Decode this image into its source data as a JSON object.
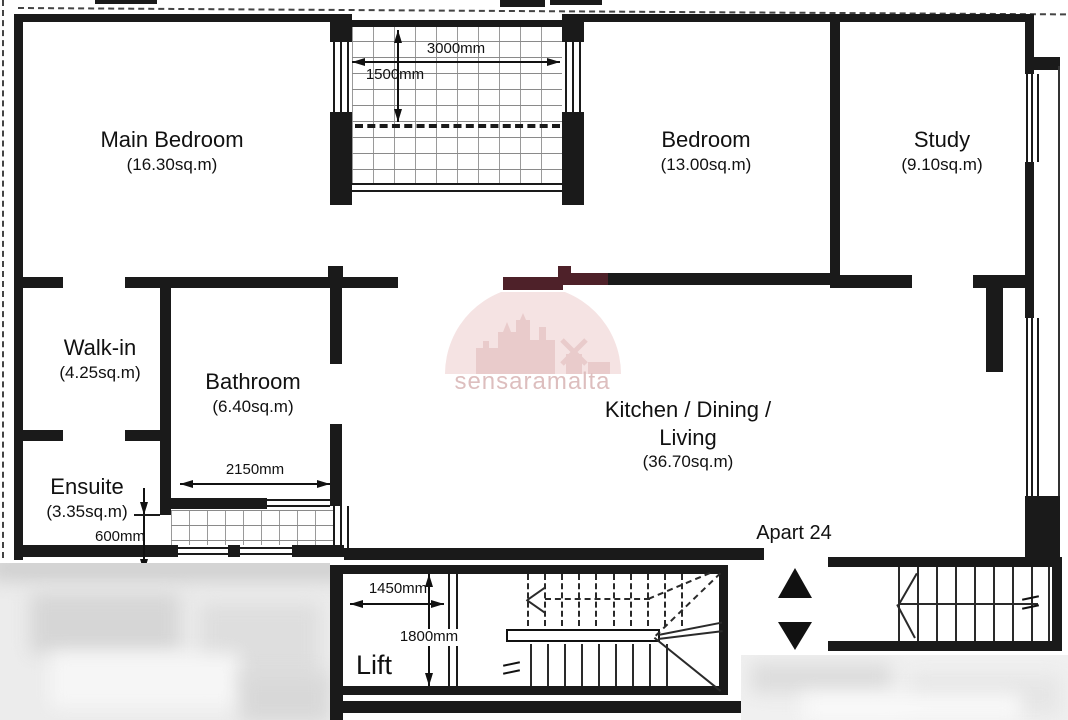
{
  "plan": {
    "apartment_label": "Apart 24",
    "watermark": {
      "brand": "sensaramalta"
    },
    "rooms": {
      "main_bedroom": {
        "name": "Main Bedroom",
        "area": "(16.30sq.m)"
      },
      "bedroom": {
        "name": "Bedroom",
        "area": "(13.00sq.m)"
      },
      "study": {
        "name": "Study",
        "area": "(9.10sq.m)"
      },
      "walk_in": {
        "name": "Walk-in",
        "area": "(4.25sq.m)"
      },
      "bathroom": {
        "name": "Bathroom",
        "area": "(6.40sq.m)"
      },
      "ensuite": {
        "name": "Ensuite",
        "area": "(3.35sq.m)"
      },
      "kitchen": {
        "name_line1": "Kitchen / Dining /",
        "name_line2": "Living",
        "area": "(36.70sq.m)"
      },
      "lift": {
        "name": "Lift"
      }
    },
    "dimensions": {
      "balcony_width": "3000mm",
      "balcony_depth": "1500mm",
      "bathroom_width": "2150mm",
      "lightwell_depth": "600mm",
      "lift_width": "1450mm",
      "stairwell_depth": "1800mm"
    },
    "colors": {
      "wall": "#1a1a1a",
      "wall_watermark_tint": "#4e2129",
      "watermark_fill": "#f5e3e3",
      "watermark_silhouette": "#e9cbcb",
      "watermark_text": "#ddbebe"
    }
  }
}
